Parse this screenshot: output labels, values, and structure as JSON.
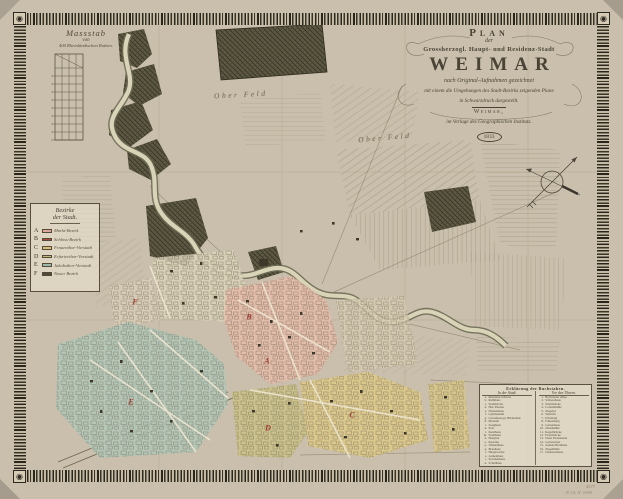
{
  "artifact": {
    "kind": "scanned historical city map",
    "year_label": "1833"
  },
  "cartouche": {
    "line1": "Plan",
    "line2": "der",
    "line3": "Grossherzogl. Haupt- und Residenz-Stadt",
    "name": "WEIMAR",
    "line5": "nach Original-Aufnahmen gezeichnet",
    "line6": "mit einem die Umgebungen des Stadt-Bezirks zeigenden Plane",
    "line7": "in Schwarzdruck dargestellt.",
    "city": "Weimar,",
    "publisher": "im Verlage des Geographischen Instituts.",
    "year": "1833"
  },
  "scalebar": {
    "title": "Massstab",
    "von": "von",
    "unit": "400 Rheinländischen Ruthen."
  },
  "legend": {
    "header1": "Bezirke",
    "header2": "der Stadt.",
    "items": [
      {
        "key": "A",
        "color": "#dfa598",
        "label": "Markt-Bezirk"
      },
      {
        "key": "B",
        "color": "#a8493c",
        "label": "Schloss-Bezirk"
      },
      {
        "key": "C",
        "color": "#d7c273",
        "label": "Frauenthor-Vorstadt"
      },
      {
        "key": "D",
        "color": "#c2bb7c",
        "label": "Erfurterthor-Vorstadt"
      },
      {
        "key": "E",
        "color": "#9db8ab",
        "label": "Jakobsthor-Vorstadt"
      },
      {
        "key": "F",
        "color": "#4e4a3c",
        "label": "Neuer Bezirk"
      }
    ]
  },
  "map_labels": {
    "field1": "Ober Feld",
    "field2": "Ober Feld"
  },
  "district_markers": [
    {
      "letter": "A",
      "x": 267,
      "y": 361
    },
    {
      "letter": "B",
      "x": 249,
      "y": 317
    },
    {
      "letter": "C",
      "x": 352,
      "y": 415
    },
    {
      "letter": "D",
      "x": 268,
      "y": 428
    },
    {
      "letter": "E",
      "x": 131,
      "y": 402
    },
    {
      "letter": "F",
      "x": 135,
      "y": 302
    }
  ],
  "index": {
    "header": "Erklärung der Buchstaben.",
    "col1_header": "In der Stadt.",
    "col2_header": "Vor den Thoren.",
    "col1": [
      {
        "k": "a.",
        "t": "Residenz-Schloss"
      },
      {
        "k": "b.",
        "t": "Rathhaus"
      },
      {
        "k": "c.",
        "t": "Stadtkirche"
      },
      {
        "k": "d.",
        "t": "Hof-Theater"
      },
      {
        "k": "e.",
        "t": "Fürstenhaus"
      },
      {
        "k": "f.",
        "t": "Gymnasium"
      },
      {
        "k": "g.",
        "t": "Grossherzogl. Bibliothek"
      },
      {
        "k": "h.",
        "t": "Marstall"
      },
      {
        "k": "i.",
        "t": "Zeughaus"
      },
      {
        "k": "k.",
        "t": "Post"
      },
      {
        "k": "l.",
        "t": "Kaufhaus"
      },
      {
        "k": "m.",
        "t": "Stadthaus"
      },
      {
        "k": "n.",
        "t": "Hospital"
      },
      {
        "k": "o.",
        "t": "Kaserne"
      },
      {
        "k": "p.",
        "t": "Waisenhaus"
      },
      {
        "k": "q.",
        "t": "Brauhaus"
      },
      {
        "k": "r.",
        "t": "Hauptwache"
      },
      {
        "k": "s.",
        "t": "Armenhaus"
      },
      {
        "k": "t.",
        "t": "Spritzenhaus"
      },
      {
        "k": "u.",
        "t": "Schulhaus"
      }
    ],
    "col2": [
      {
        "k": "1.",
        "t": "Belvederer Allee"
      },
      {
        "k": "2.",
        "t": "Schiesshaus"
      },
      {
        "k": "3.",
        "t": "Sternbrücke"
      },
      {
        "k": "4.",
        "t": "Lottenmühle"
      },
      {
        "k": "5.",
        "t": "Ziegelei"
      },
      {
        "k": "6.",
        "t": "Webicht"
      },
      {
        "k": "7.",
        "t": "Erholung"
      },
      {
        "k": "8.",
        "t": "Falkenburg"
      },
      {
        "k": "9.",
        "t": "Gartenhaus"
      },
      {
        "k": "10.",
        "t": "Obermühle"
      },
      {
        "k": "11.",
        "t": "Kegelbrücke"
      },
      {
        "k": "12.",
        "t": "Flossbrücke"
      },
      {
        "k": "13.",
        "t": "Neue Promenade"
      },
      {
        "k": "14.",
        "t": "Gottesacker"
      },
      {
        "k": "15.",
        "t": "Armen-Brauhaus"
      },
      {
        "k": "16.",
        "t": "Ziegelhütte"
      },
      {
        "k": "17.",
        "t": "Chausseehaus"
      }
    ]
  },
  "annotations": {
    "pencil1": "4577",
    "pencil2": "P. 14. N. 1690."
  },
  "palette": {
    "paper": "#c9bfac",
    "field": "#e8dfca",
    "ink": "#3f382b",
    "district_pink": "#e6bcab",
    "district_yellow": "#dcc98a",
    "district_teal": "#b3c6b8",
    "district_olive": "#cbc287",
    "river": "#d9d4b8"
  }
}
